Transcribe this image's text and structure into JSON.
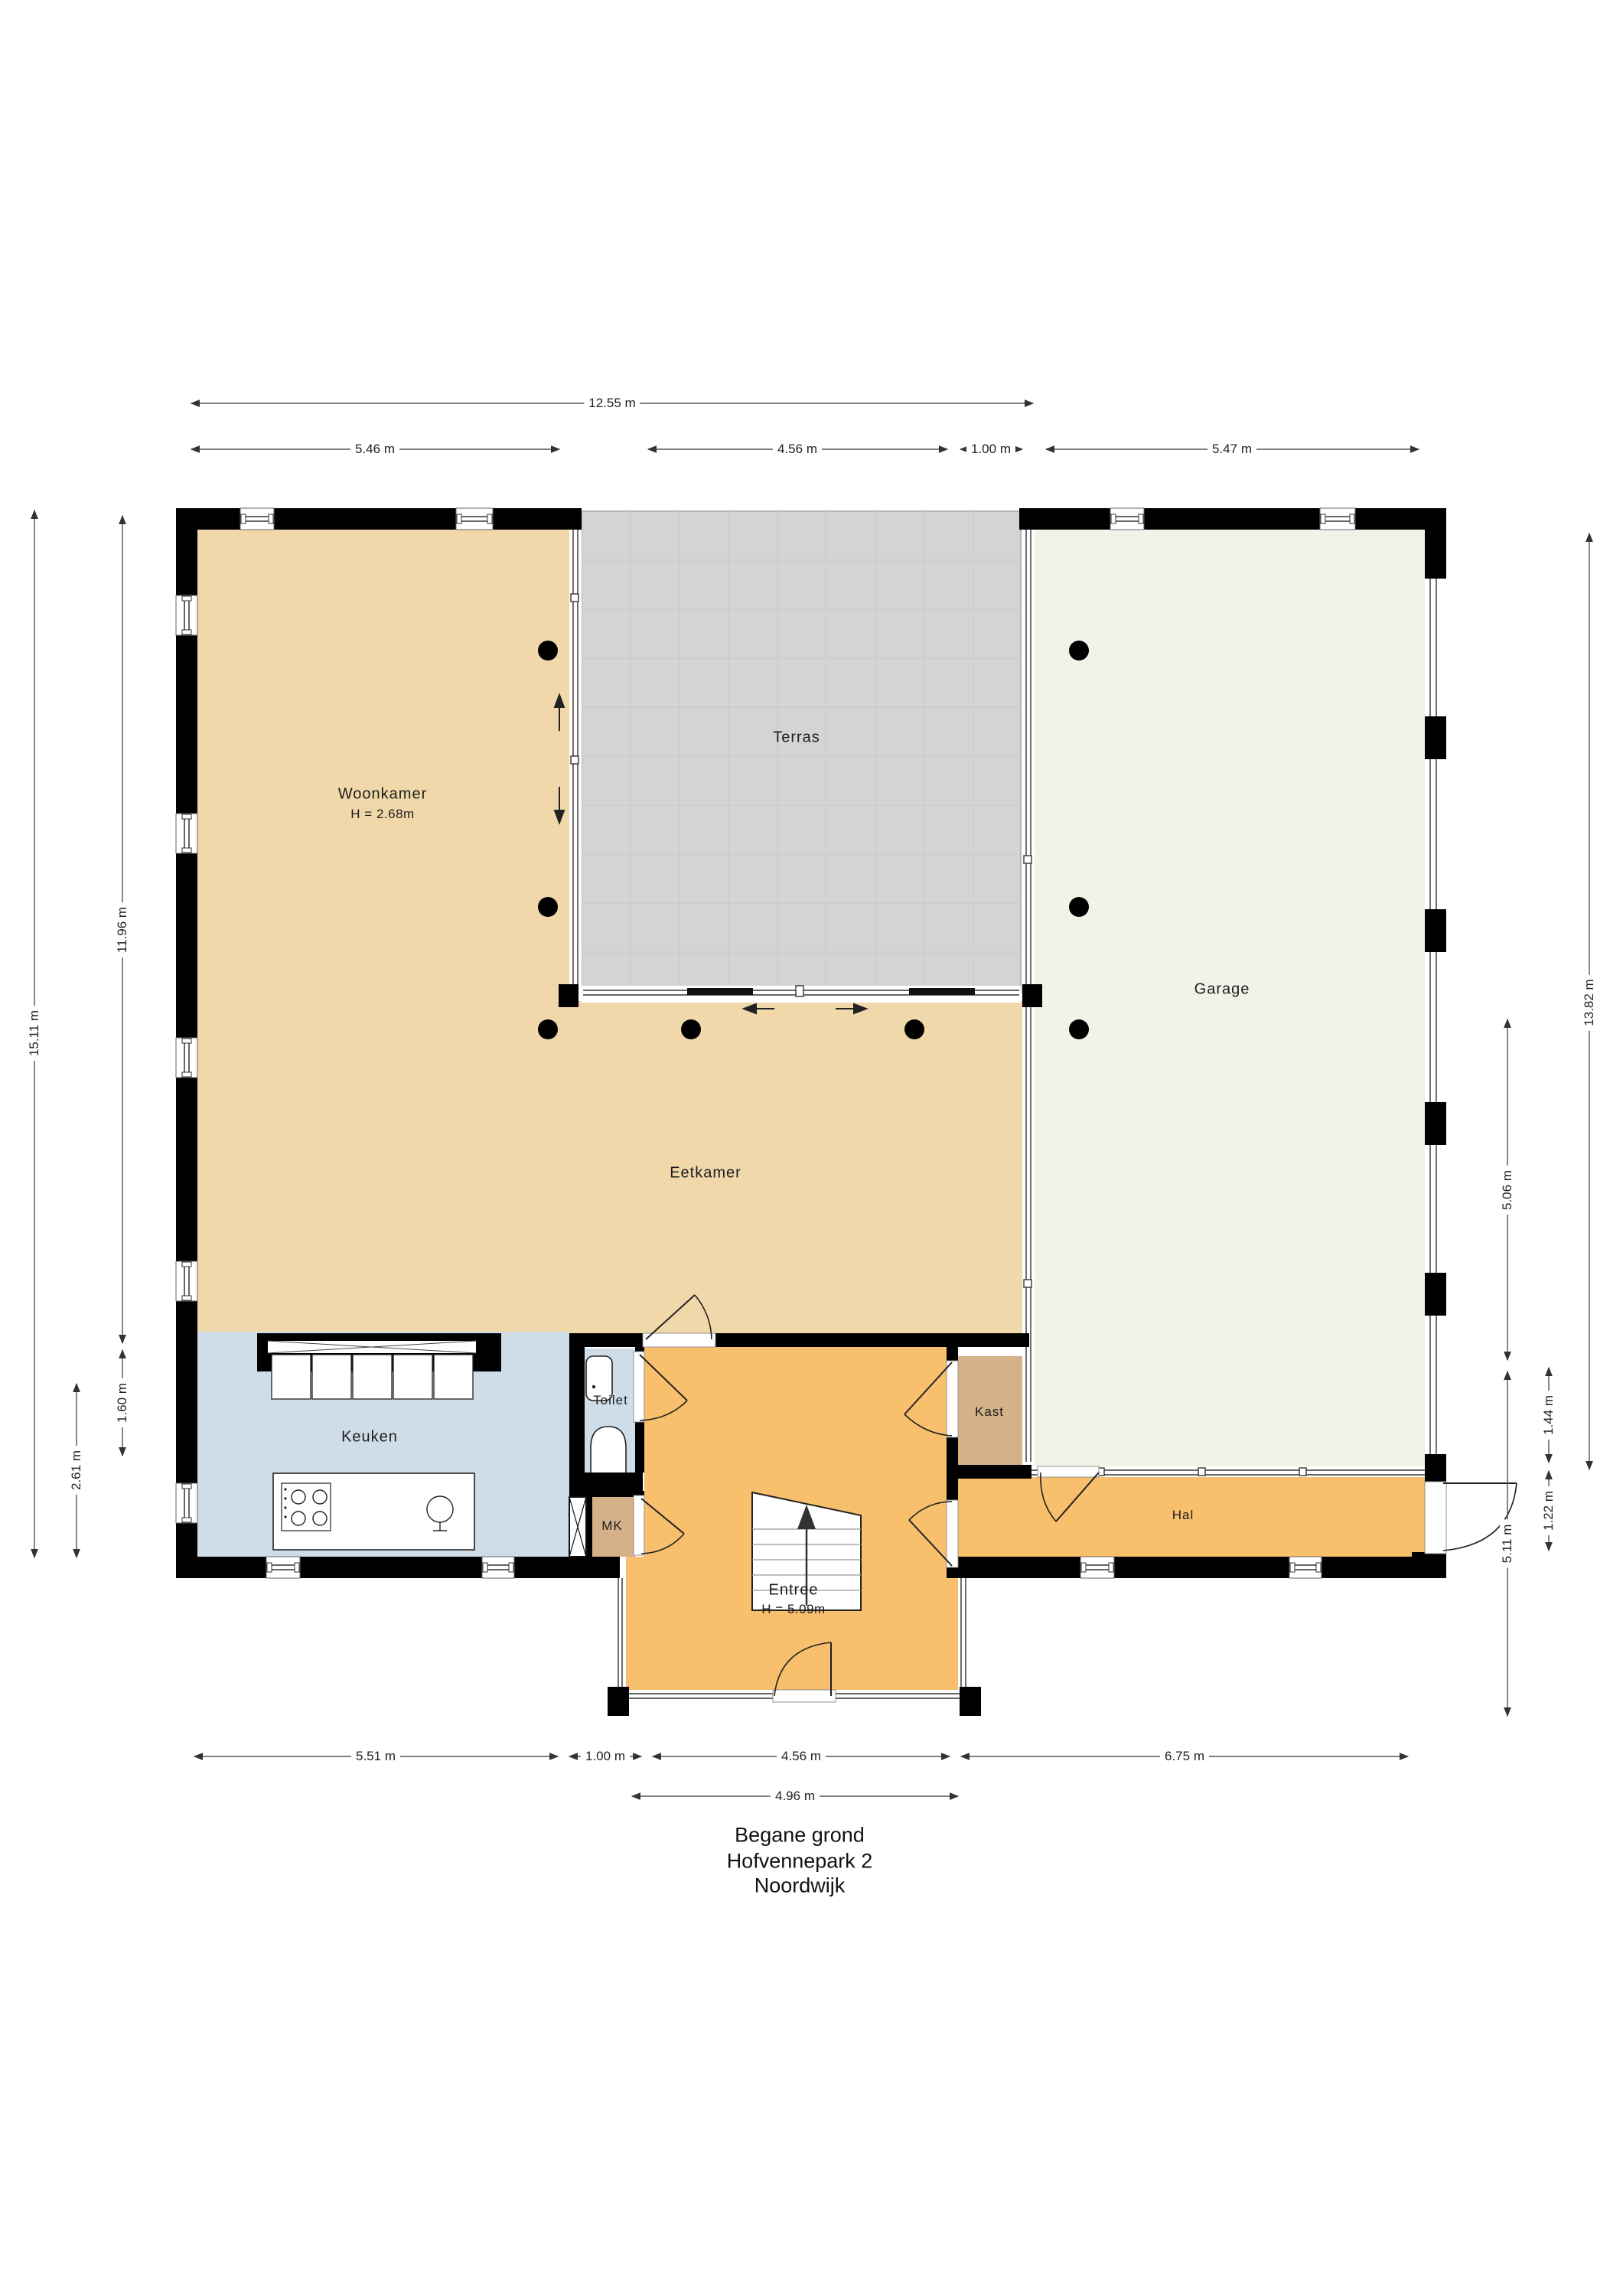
{
  "title": {
    "lines": [
      "Begane grond",
      "Hofvennepark 2",
      "Noordwijk"
    ]
  },
  "rooms": {
    "woonkamer": {
      "label": "Woonkamer",
      "height_note": "H = 2.68m"
    },
    "terras": {
      "label": "Terras"
    },
    "garage": {
      "label": "Garage"
    },
    "eetkamer": {
      "label": "Eetkamer"
    },
    "keuken": {
      "label": "Keuken"
    },
    "toilet": {
      "label": "Toilet"
    },
    "mk": {
      "label": "MK"
    },
    "kast": {
      "label": "Kast"
    },
    "hal": {
      "label": "Hal"
    },
    "entree": {
      "label": "Entree",
      "height_note": "H = 5.09m"
    }
  },
  "dimensions": {
    "top": [
      {
        "label": "12.55 m"
      },
      {
        "label": "5.46 m"
      },
      {
        "label": "4.56 m"
      },
      {
        "label": "1.00 m"
      },
      {
        "label": "5.47 m"
      }
    ],
    "bottom": [
      {
        "label": "5.51 m"
      },
      {
        "label": "1.00 m"
      },
      {
        "label": "4.56 m"
      },
      {
        "label": "6.75 m"
      },
      {
        "label": "4.96 m"
      }
    ],
    "left": [
      {
        "label": "15.11 m"
      },
      {
        "label": "11.96 m"
      },
      {
        "label": "1.60 m"
      },
      {
        "label": "2.61 m"
      }
    ],
    "right": [
      {
        "label": "13.82 m"
      },
      {
        "label": "5.06 m"
      },
      {
        "label": "1.44 m"
      },
      {
        "label": "1.22 m"
      },
      {
        "label": "5.11 m"
      }
    ]
  },
  "colors": {
    "wall": "#000000",
    "living_tan": "#f1d8aa",
    "hall_orange": "#f8bf6d",
    "kitchen_blue": "#cfdde9",
    "closet_brown": "#d4b189",
    "garage_cream": "#f2f2e8",
    "terrace_grey": "#d4d4d4"
  }
}
